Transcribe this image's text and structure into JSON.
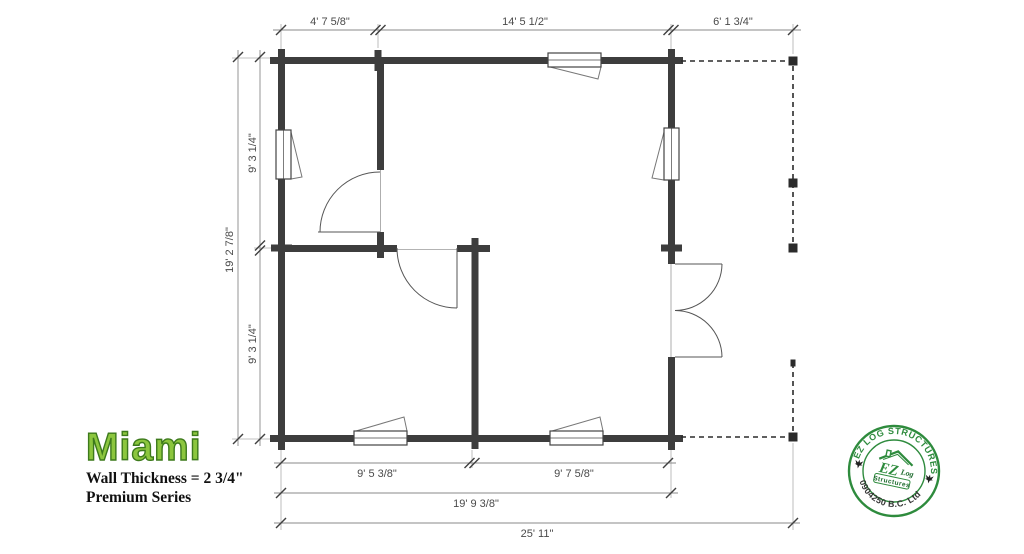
{
  "title_block": {
    "model_name": "Miami",
    "wall_thickness": "Wall Thickness = 2 3/4\"",
    "series": "Premium Series",
    "accent_green": "#8cc63e",
    "outline_green": "#3d7a1c"
  },
  "dimensions": {
    "top_segments": [
      "4' 7 5/8\"",
      "14' 5 1/2\"",
      "6' 1 3/4\""
    ],
    "left_overall": "19' 2 7/8\"",
    "left_upper": "9' 3 1/4\"",
    "left_lower": "9' 3 1/4\"",
    "bottom_left": "9' 5 3/8\"",
    "bottom_right": "9' 7 5/8\"",
    "bottom_building": "19' 9 3/8\"",
    "bottom_overall": "25' 11\""
  },
  "stamp": {
    "arc_top": "EZ LOG STRUCTURES",
    "arc_bottom": "0904250 B.C. Ltd",
    "ez": "EZ",
    "log": "Log",
    "structures": "Structures",
    "green": "#2e8b3d"
  },
  "plan": {
    "wall_color": "#3d3d3d",
    "dim_color": "#4a4a4a"
  }
}
